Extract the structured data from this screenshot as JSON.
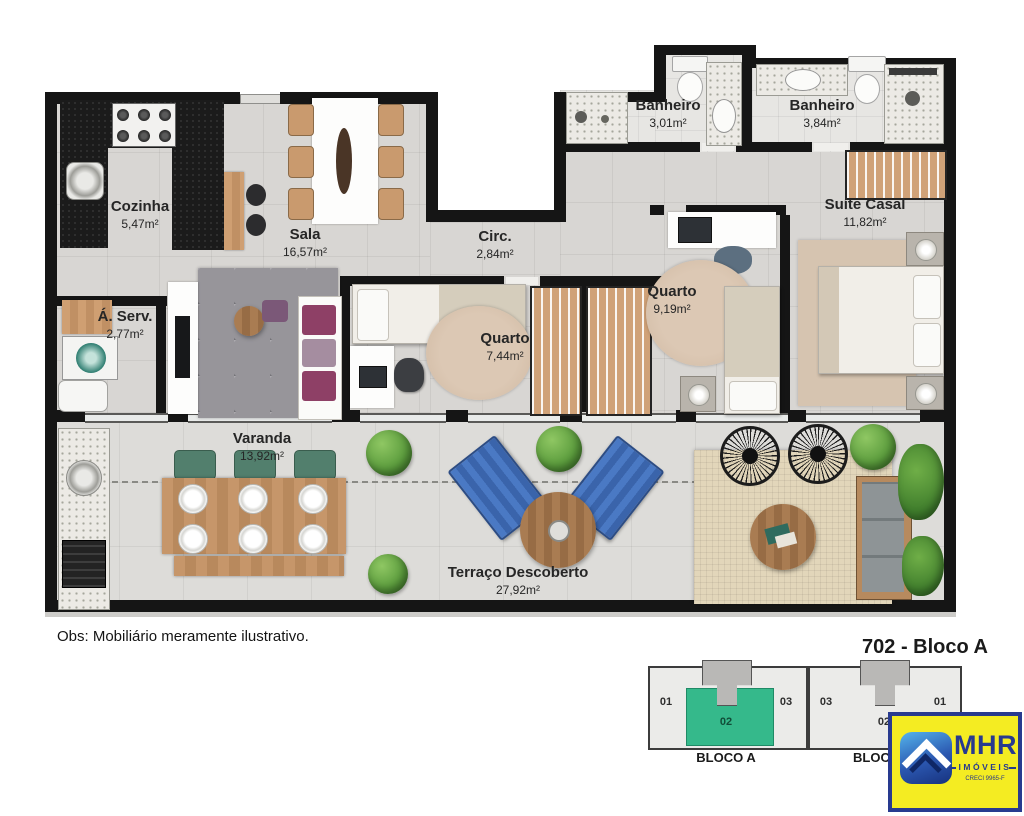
{
  "plan": {
    "note": "Obs: Mobiliário meramente ilustrativo.",
    "rooms": [
      {
        "id": "cozinha",
        "name": "Cozinha",
        "area": "5,47m²"
      },
      {
        "id": "sala",
        "name": "Sala",
        "area": "16,57m²"
      },
      {
        "id": "banheiro-1",
        "name": "Banheiro",
        "area": "3,01m²"
      },
      {
        "id": "banheiro-2",
        "name": "Banheiro",
        "area": "3,84m²"
      },
      {
        "id": "suite-casal",
        "name": "Suíte Casal",
        "area": "11,82m²"
      },
      {
        "id": "circ",
        "name": "Circ.",
        "area": "2,84m²"
      },
      {
        "id": "quarto-1",
        "name": "Quarto",
        "area": "7,44m²"
      },
      {
        "id": "quarto-2",
        "name": "Quarto",
        "area": "9,19m²"
      },
      {
        "id": "area-servico",
        "name": "Á. Serv.",
        "area": "2,77m²"
      },
      {
        "id": "varanda",
        "name": "Varanda",
        "area": "13,92m²"
      },
      {
        "id": "terraco",
        "name": "Terraço Descoberto",
        "area": "27,92m²"
      }
    ]
  },
  "keyplan": {
    "title": "702 - Bloco A",
    "blocks": [
      {
        "label": "BLOCO A",
        "units": [
          "01",
          "02",
          "03"
        ],
        "highlighted_unit": "02"
      },
      {
        "label": "BLOCO B",
        "units": [
          "03",
          "02",
          "01"
        ]
      }
    ]
  },
  "logo": {
    "brand": "MHR",
    "subtitle": "IMÓVEIS",
    "registration": "CRECI 9965-F"
  },
  "colors": {
    "highlight_green": "#35b98b",
    "wall_black": "#151515",
    "logo_yellow": "#f4ec22",
    "logo_blue": "#283a8f",
    "lounger_blue": "#3f6db8"
  }
}
